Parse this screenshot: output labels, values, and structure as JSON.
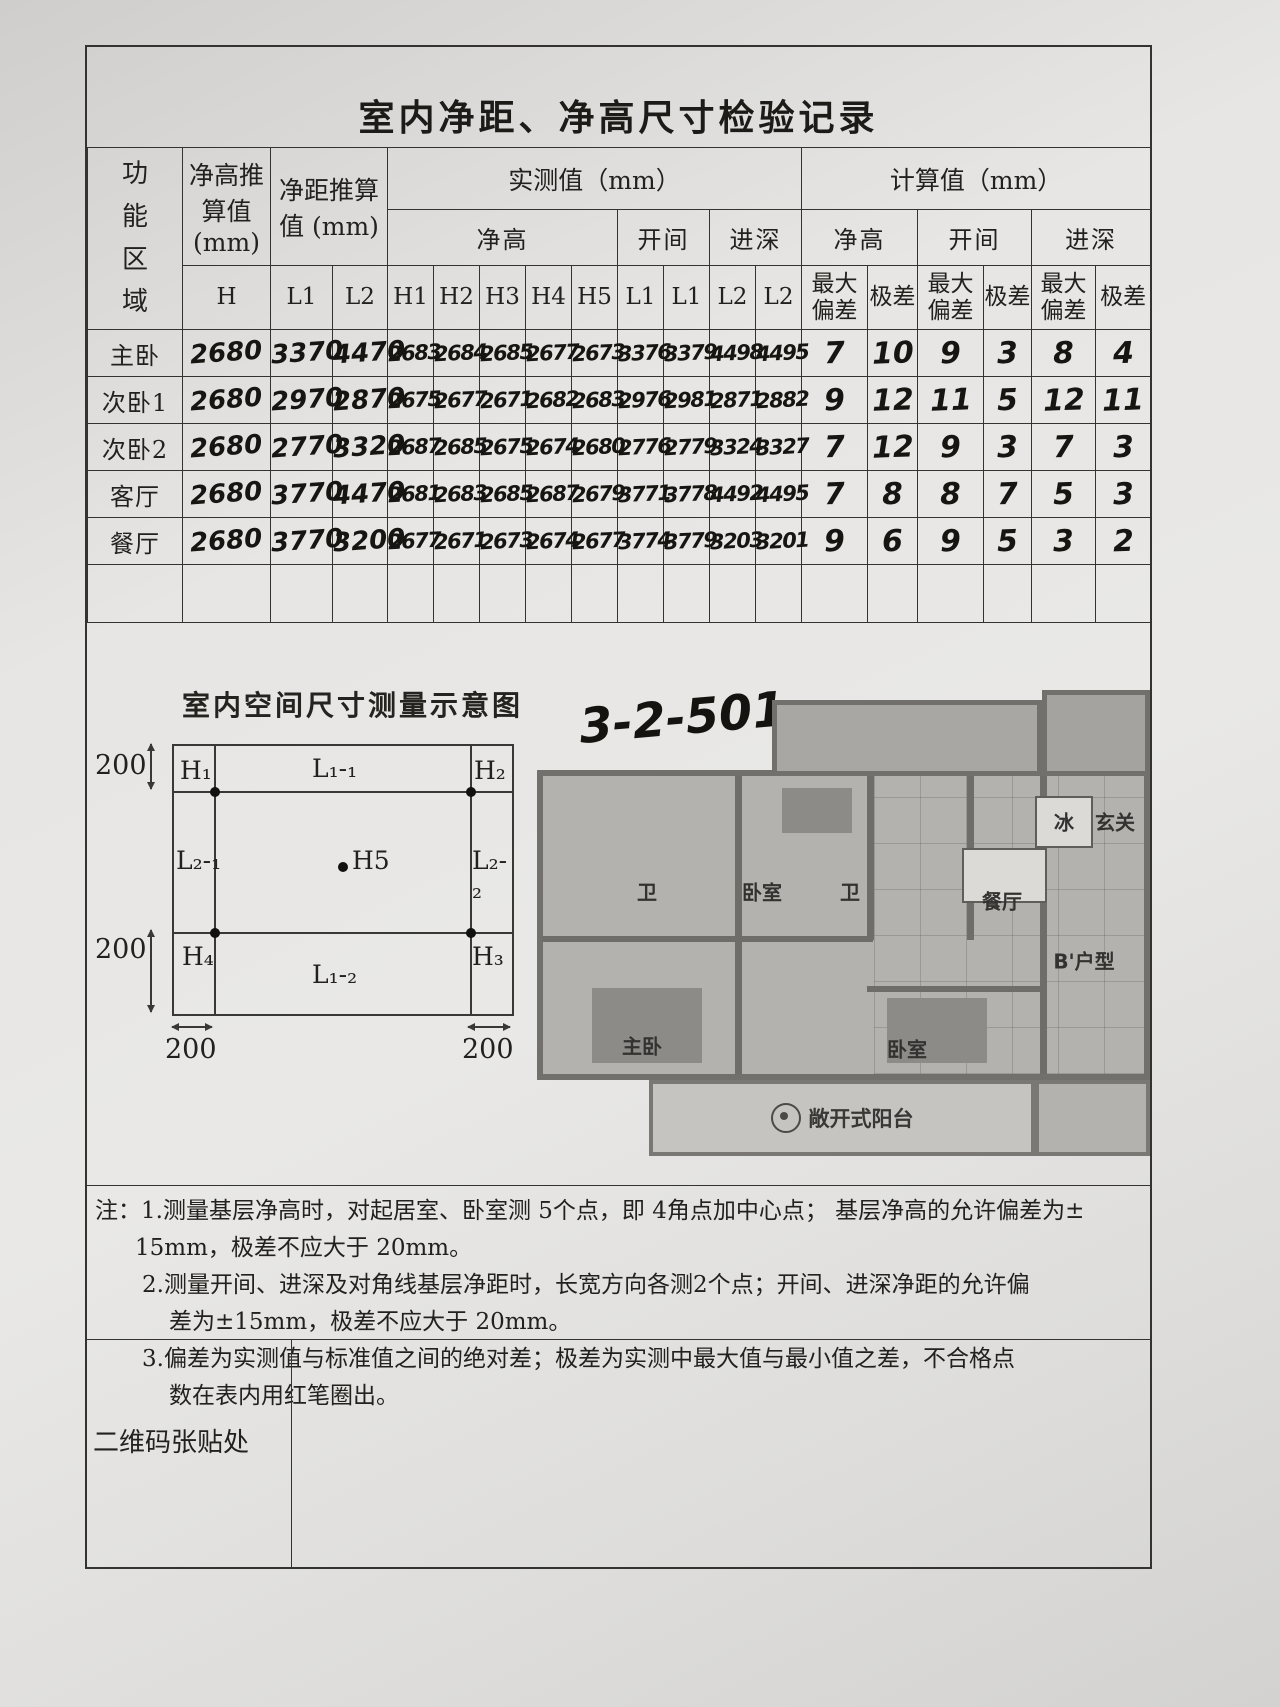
{
  "title": "室内净距、净高尺寸检验记录",
  "table": {
    "corner": "功能区域",
    "groups": {
      "h_std": "净高推算值 (mm)",
      "l_std": "净距推算值 (mm)",
      "measured": "实测值（mm）",
      "calculated": "计算值（mm）"
    },
    "measured_subs": [
      "净高",
      "开间",
      "进深"
    ],
    "calc_subs": [
      "净高",
      "开间",
      "进深"
    ],
    "col_heads": [
      "H",
      "L1",
      "L2",
      "H1",
      "H2",
      "H3",
      "H4",
      "H5",
      "L1",
      "L1",
      "L2",
      "L2",
      "最大偏差",
      "极差",
      "最大偏差",
      "极差",
      "最大偏差",
      "极差"
    ],
    "rows": [
      {
        "cells": [
          "主卧",
          "2680",
          "3370",
          "4470",
          "2683",
          "2684",
          "2685",
          "2677",
          "2673",
          "3376",
          "3379",
          "4498",
          "4495",
          "7",
          "10",
          "9",
          "3",
          "8",
          "4"
        ]
      },
      {
        "cells": [
          "次卧1",
          "2680",
          "2970",
          "2870",
          "2675",
          "2677",
          "2671",
          "2682",
          "2683",
          "2976",
          "2981",
          "2871",
          "2882",
          "9",
          "12",
          "11",
          "5",
          "12",
          "11"
        ]
      },
      {
        "cells": [
          "次卧2",
          "2680",
          "2770",
          "3320",
          "2687",
          "2685",
          "2675",
          "2674",
          "2680",
          "2776",
          "2779",
          "3324",
          "3327",
          "7",
          "12",
          "9",
          "3",
          "7",
          "3"
        ]
      },
      {
        "cells": [
          "客厅",
          "2680",
          "3770",
          "4470",
          "2681",
          "2683",
          "2685",
          "2687",
          "2679",
          "3771",
          "3778",
          "4492",
          "4495",
          "7",
          "8",
          "8",
          "7",
          "5",
          "3"
        ]
      },
      {
        "cells": [
          "餐厅",
          "2680",
          "3770",
          "3200",
          "2677",
          "2671",
          "2673",
          "2674",
          "2677",
          "3774",
          "3779",
          "3203",
          "3201",
          "9",
          "6",
          "9",
          "5",
          "3",
          "2"
        ]
      },
      {
        "cells": [
          "",
          "",
          "",
          "",
          "",
          "",
          "",
          "",
          "",
          "",
          "",
          "",
          "",
          "",
          "",
          "",
          "",
          "",
          ""
        ]
      }
    ]
  },
  "diagram": {
    "title": "室内空间尺寸测量示意图",
    "points": {
      "h1": "H₁",
      "h2": "H₂",
      "h3": "H₃",
      "h4": "H₄",
      "h5": "H5"
    },
    "edges": {
      "top": "L₁-₁",
      "bottom": "L₁-₂",
      "left": "L₂-₁",
      "right": "L₂-₂"
    },
    "dims": {
      "top_left": "200",
      "bottom_left": "200",
      "bottom_first": "200",
      "bottom_second": "200"
    }
  },
  "floorplan": {
    "unit_code": "3-2-501",
    "rooms": {
      "bath1": "卫",
      "bedroom_top": "卧室",
      "bath2": "卫",
      "fridge": "冰",
      "entry": "玄关",
      "dining": "餐厅",
      "unit_type": "B'户型",
      "master": "主卧",
      "bedroom2": "卧室",
      "balcony": "敞开式阳台"
    }
  },
  "notes": [
    "注：1.测量基层净高时，对起居室、卧室测 5个点，即 4角点加中心点；  基层净高的允许偏差为±",
    "15mm，极差不应大于 20mm。",
    "2.测量开间、进深及对角线基层净距时，长宽方向各测2个点；开间、进深净距的允许偏",
    "差为±15mm，极差不应大于 20mm。",
    "3.偏差为实测值与标准值之间的绝对差；极差为实测中最大值与最小值之差，不合格点",
    "数在表内用红笔圈出。"
  ],
  "qr_label": "二维码张贴处"
}
